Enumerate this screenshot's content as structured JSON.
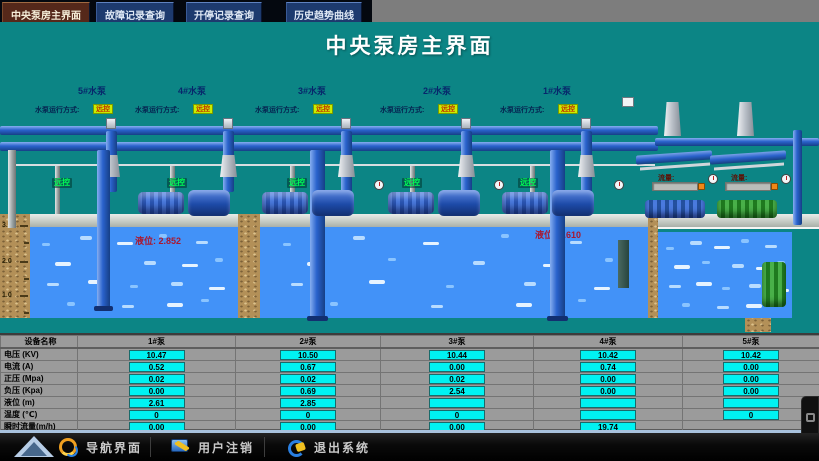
{
  "tabs": [
    {
      "label": "中央泵房主界面",
      "active": true
    },
    {
      "label": "故障记录查询",
      "active": false
    },
    {
      "label": "开停记录查询",
      "active": false
    },
    {
      "label": "历史趋势曲线",
      "active": false
    }
  ],
  "title": "中央泵房主界面",
  "diagram": {
    "pump_groups": [
      {
        "name": "5#水泵",
        "mode_label": "水泵运行方式:",
        "mode_value": "远控"
      },
      {
        "name": "4#水泵",
        "mode_label": "水泵运行方式:",
        "mode_value": "远控"
      },
      {
        "name": "3#水泵",
        "mode_label": "水泵运行方式:",
        "mode_value": "远控"
      },
      {
        "name": "2#水泵",
        "mode_label": "水泵运行方式:",
        "mode_value": "远控"
      },
      {
        "name": "1#水泵",
        "mode_label": "水泵运行方式:",
        "mode_value": "远控"
      }
    ],
    "panel_tags": [
      "远控",
      "远控",
      "远控",
      "远控",
      "远控"
    ],
    "aux_pumps": [
      {
        "label": "流量:"
      },
      {
        "label": "流量:"
      }
    ],
    "tanks": [
      {
        "level_label": "液位:",
        "level_value": "2.852"
      },
      {
        "level_label": "液位:",
        "level_value": "2.610"
      }
    ],
    "scale_marks": [
      "3.0",
      "2.0",
      "1.0"
    ]
  },
  "table": {
    "header": [
      "设备名称",
      "1#泵",
      "2#泵",
      "3#泵",
      "4#泵",
      "5#泵"
    ],
    "rows": [
      {
        "label": "电压 (KV)",
        "values": [
          "10.47",
          "10.50",
          "10.44",
          "10.42",
          "10.42"
        ]
      },
      {
        "label": "电流 (A)",
        "values": [
          "0.52",
          "0.67",
          "0.00",
          "0.74",
          "0.00"
        ]
      },
      {
        "label": "正压 (Mpa)",
        "values": [
          "0.02",
          "0.02",
          "0.02",
          "0.00",
          "0.00"
        ]
      },
      {
        "label": "负压 (Kpa)",
        "values": [
          "0.00",
          "0.69",
          "2.54",
          "0.00",
          "0.00"
        ]
      },
      {
        "label": "液位 (m)",
        "values": [
          "2.61",
          "2.85",
          "",
          "",
          ""
        ]
      },
      {
        "label": "温度 (℃)",
        "values": [
          "0",
          "0",
          "0",
          "",
          "0"
        ]
      },
      {
        "label": "瞬时流量(m/h)",
        "values": [
          "0.00",
          "0.00",
          "0.00",
          "19.74",
          null
        ]
      }
    ]
  },
  "footer": {
    "buttons": [
      {
        "label": "导航界面"
      },
      {
        "label": "用户注销"
      },
      {
        "label": "退出系统"
      }
    ]
  },
  "colors": {
    "teal": "#0c8585",
    "water": "#4292f8",
    "cyan": "#00f2f2",
    "remote_green": "#00ff55",
    "badge_bg": "#c8ee00",
    "badge_text": "#c03000",
    "level_text": "#a81830",
    "table_bg": "#9b9b9b",
    "soil": "#b39058"
  }
}
